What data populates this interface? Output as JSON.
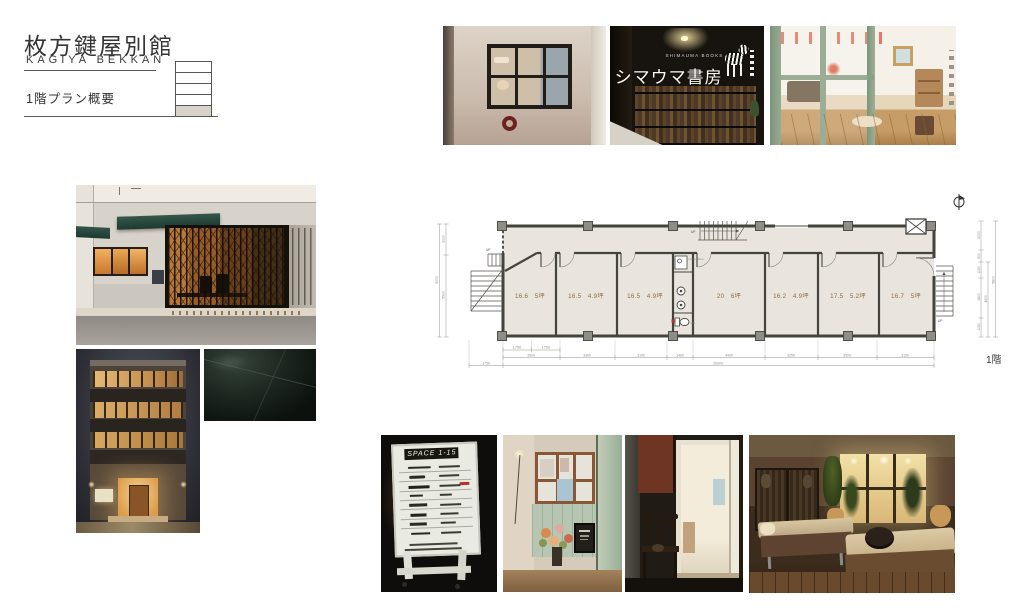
{
  "header": {
    "title": "枚方鍵屋別館",
    "subtitle": "KAGIYA BEKKAN",
    "page_label": "1階プラン概要"
  },
  "floor_plan": {
    "floor_label": "1階",
    "up_label": "UP",
    "wc_label": "WC",
    "kitchen_label": "mini kitchen",
    "rooms": [
      "16.6　5坪",
      "16.5　4.9坪",
      "16.5　4.9坪",
      "20　6坪",
      "16.2　4.9坪",
      "17.5　5.2坪",
      "16.7　5坪"
    ],
    "dims_bottom_sub": [
      "1750",
      "1750"
    ],
    "dims_bottom": [
      "3500",
      "3300",
      "3100",
      "1480",
      "4400",
      "3250",
      "3500",
      "3150"
    ],
    "dims_bottom_offset": "1750",
    "dims_bottom_total": "26000",
    "dims_left": [
      "3000",
      "5900"
    ],
    "dims_left_total": "9000",
    "dims_right": [
      "2000",
      "500",
      "1150",
      "1800",
      "1150"
    ],
    "dims_right_mid": "4500",
    "dims_right_total": "5800",
    "colors": {
      "plan_floor": "#e9e5de",
      "plan_wall": "#45433e",
      "room_label": "#8d6a40"
    }
  },
  "photos": {
    "bookstore": {
      "sign_en": "SHIMAUMA BOOKS",
      "sign_jp": "シマウマ書房"
    },
    "signboard": {
      "title": "SPACE 1-15"
    }
  }
}
